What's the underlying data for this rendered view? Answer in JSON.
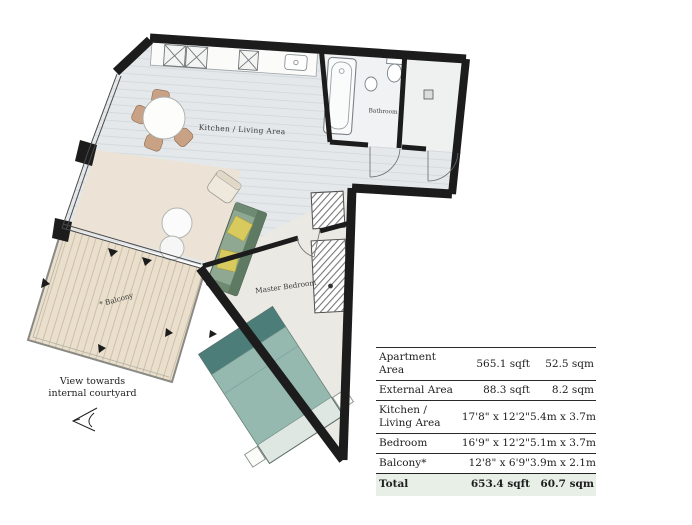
{
  "plan": {
    "labels": {
      "kitchen_living": "Kitchen / Living Area",
      "bathroom": "Bathroom",
      "master_bedroom": "Master Bedroom",
      "balcony": "* Balcony"
    },
    "view_note": {
      "line1": "View towards",
      "line2": "internal courtyard"
    }
  },
  "area_table": {
    "rows": [
      {
        "label": "Apartment Area",
        "imperial": "565.1 sqft",
        "metric": "52.5 sqm"
      },
      {
        "label": "External Area",
        "imperial": "88.3 sqft",
        "metric": "8.2 sqm"
      },
      {
        "label": "Kitchen / Living Area",
        "imperial": "17'8\" x 12'2\"",
        "metric": "5.4m x 3.7m"
      },
      {
        "label": "Bedroom",
        "imperial": "16'9\" x 12'2\"",
        "metric": "5.1m x 3.7m"
      },
      {
        "label": "Balcony*",
        "imperial": "12'8\" x 6'9\"",
        "metric": "3.9m x 2.1m"
      }
    ],
    "total": {
      "label": "Total",
      "imperial": "653.4 sqft",
      "metric": "60.7 sqm"
    }
  },
  "colors": {
    "wall": "#1c1c1c",
    "floor": "#e4e8ea",
    "rug": "#ece3d6",
    "bedroom_floor": "#ebe9e4",
    "balcony_deck": "#e9dfcc",
    "sofa_green": "#8fa892",
    "cushion_yellow": "#d9ca5e",
    "bed_teal_dark": "#4d7d79",
    "bed_teal_light": "#95b8af",
    "total_row_bg": "#e7efe7"
  }
}
